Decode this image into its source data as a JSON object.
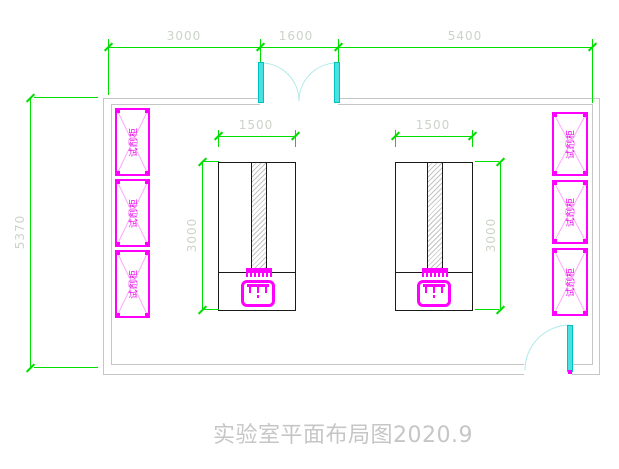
{
  "drawing": {
    "title": "实验室平面布局图2020.9",
    "type": "laboratory floor plan"
  },
  "dimensions": {
    "top_segments": [
      "3000",
      "1600",
      "5400"
    ],
    "room_height": "5370",
    "bench_width": "1500",
    "bench_depth": "3000"
  },
  "labels": {
    "cabinet": "试剂柜"
  },
  "colors": {
    "dimension_green": "#00dd00",
    "dimension_text": "#ccd3c8",
    "cabinet_magenta": "#ff00ff",
    "cabinet_hatch_pink": "#ffa6ff",
    "door_cyan": "#49e2e2",
    "door_arc_cyan": "#aee9e9",
    "wall_gray": "#c6c6c6",
    "bench_black": "#1a1a1a",
    "title_gray": "#c6c6c6"
  }
}
